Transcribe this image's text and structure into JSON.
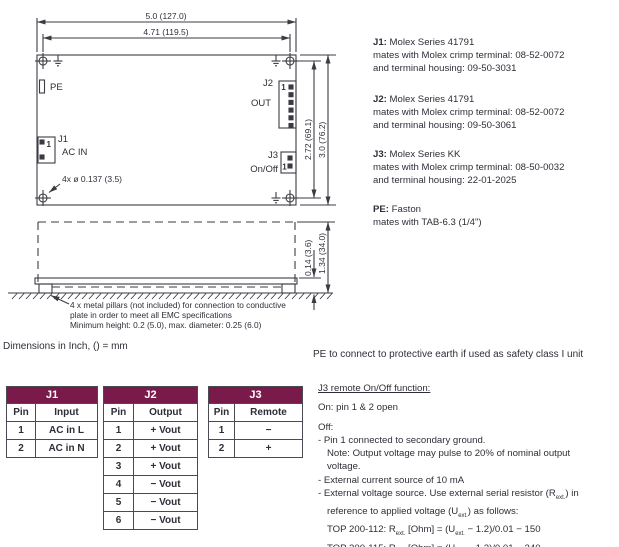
{
  "page": {
    "accent": "#7a1a4a",
    "text_color": "#2e2e38"
  },
  "drawing": {
    "dim_width_outer": "5.0 (127.0)",
    "dim_width_inner": "4.71 (119.5)",
    "dim_height_inner": "2.72 (69.1)",
    "dim_height_outer": "3.0 (76.2)",
    "hole_note": "4x ø 0.137 (3.5)",
    "pe_label": "PE",
    "j1_label": "J1",
    "j1_sub": "AC IN",
    "j1_pin1": "1",
    "j2_label": "J2",
    "j2_sub": "OUT",
    "j2_pin1": "1",
    "j3_label": "J3",
    "j3_sub": "On/Off",
    "j3_pin1": "1",
    "side": {
      "dim_small": "0.14 (3.6)",
      "dim_large": "1.34 (34.0)",
      "pillar_note_1": "4 x metal pillars (not included) for connection to conductive",
      "pillar_note_2": "plate in order to meet all EMC specifications",
      "pillar_note_3": "Minimum height:  0.2 (5.0), max. diameter: 0.25 (6.0)"
    },
    "units_note": "Dimensions in Inch, () = mm"
  },
  "connector_specs": [
    {
      "id": "J1:",
      "series": " Molex Series 41791",
      "line2": "mates with Molex crimp terminal: 08-52-0072",
      "line3": "and terminal housing: 09-50-3031"
    },
    {
      "id": "J2:",
      "series": " Molex Series 41791",
      "line2": "mates with Molex crimp terminal: 08-52-0072",
      "line3": "and terminal housing: 09-50-3061"
    },
    {
      "id": "J3:",
      "series": " Molex Series KK",
      "line2": "mates with Molex crimp terminal: 08-50-0032",
      "line3": "and terminal housing: 22-01-2025"
    },
    {
      "id": "PE:",
      "series": " Faston",
      "line2": "mates with TAB-6.3 (1/4\")"
    }
  ],
  "pe_note": "PE to connect to protective earth if used as safety class I unit",
  "tables": [
    {
      "title": "J1",
      "cols": [
        "Pin",
        "Input"
      ],
      "rows": [
        [
          "1",
          "AC in L"
        ],
        [
          "2",
          "AC in N"
        ]
      ]
    },
    {
      "title": "J2",
      "cols": [
        "Pin",
        "Output"
      ],
      "rows": [
        [
          "1",
          "+ Vout"
        ],
        [
          "2",
          "+ Vout"
        ],
        [
          "3",
          "+ Vout"
        ],
        [
          "4",
          "− Vout"
        ],
        [
          "5",
          "− Vout"
        ],
        [
          "6",
          "− Vout"
        ]
      ]
    },
    {
      "title": "J3",
      "cols": [
        "Pin",
        "Remote"
      ],
      "rows": [
        [
          "1",
          "−"
        ],
        [
          "2",
          "+"
        ]
      ]
    }
  ],
  "remote": {
    "title": "J3 remote On/Off function:",
    "on_line": "On: pin 1 & 2 open",
    "off_line": "Off:",
    "b1": "- Pin 1 connected to secondary ground.",
    "b1_note1": "Note: Output voltage may pulse to 20% of nominal output",
    "b1_note2": "voltage.",
    "b2": "- External current source of 10 mA",
    "sub": "ext.",
    "b3_pre": "- External voltage source. Use external serial resistor (R",
    "b3_post": ") in",
    "b3b_pre": "reference to applied voltage (U",
    "b3b_post": ") as follows:",
    "f112_pre": "TOP 200-112: R",
    "f112_mid": " [Ohm] = (U",
    "f112_post": " − 1.2)/0.01 − 150",
    "f115_pre": "TOP 200-115: R",
    "f115_mid": " [Ohm] = (U",
    "f115_post": " − 1.2)/0.01 − 240"
  }
}
